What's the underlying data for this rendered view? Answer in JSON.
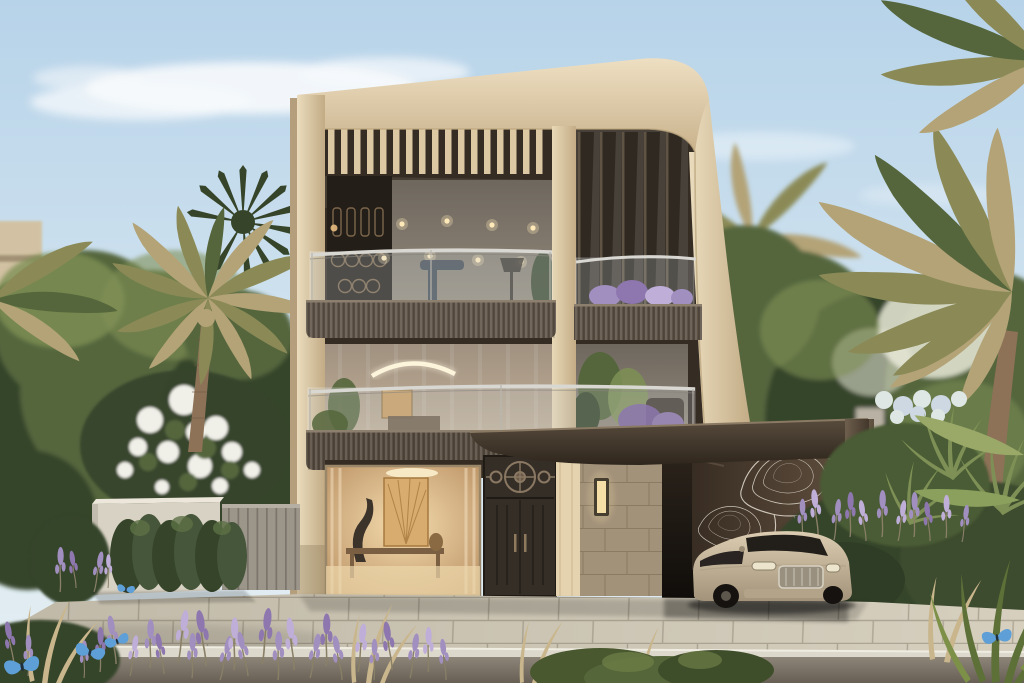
{
  "meta": {
    "title": "Luxury modern villa — daylight architectural rendering",
    "medium": "photorealistic exterior render"
  },
  "scene": {
    "setting": "Three-storey contemporary luxury villa framed by a sculptural cream travertine shell with a large rounded top corner",
    "sky": "clear pale blue sky with soft white clouds",
    "lighting": "bright daylight, sun from the upper left",
    "landscape": [
      "date palm trees",
      "dark fan palm",
      "dense green background trees",
      "white flowering shrub over garden wall",
      "clipped green hedge",
      "grey slatted garden fence",
      "lavender beds with dried grasses",
      "ferns and tropical foliage",
      "pale blue hydrangea shrub",
      "purple flower spikes"
    ],
    "foreground": "stone-paved driveway with light curb and planted verge",
    "background_left": "beige low-rise building behind trees"
  },
  "villa": {
    "unit_number": "01",
    "storeys": 3,
    "top_floor": [
      "timber pergola slats under curved roof frame",
      "dark bronze mashrabiya screen panel",
      "glass-walled gym with warm ceiling spotlights, treadmill, floor lamp and plant",
      "curved glass balustrade balcony with ribbed bronze fascia",
      "tapered vertical bronze fins over glazing",
      "small balcony with lavender planter"
    ],
    "middle_floor": [
      "full-height glazing with sheer curtains",
      "curved white pendant light",
      "wall artwork and console",
      "indoor plants and armchair",
      "continuous curved glass balcony"
    ],
    "ground_floor": [
      "living room picture window with gold fan artwork, chandelier, sculpture and console",
      "dark bronze entrance door with circular rosette transom",
      "travertine stone-block wall with glowing sconce",
      "cream timber jamb column"
    ],
    "carport": {
      "roof": "dark bronze cantilevered canopy with slatted soffit",
      "wall_art": "white topographic contour-line artwork on bronze wall",
      "pillar": "bronze pillar with unit number",
      "car": "champagne luxury coupe with chrome grille"
    }
  },
  "wildlife": {
    "butterflies": {
      "count": 5,
      "color_name": "blue"
    }
  },
  "palette": {
    "sky-top": "#b7d3e9",
    "sky-low": "#dceaf2",
    "cloud": "#f7fafc",
    "frame-light": "#ecddc0",
    "frame": "#d9c6a2",
    "frame-dark": "#bda57f",
    "bronze-dark": "#352c24",
    "bronze": "#4a3f33",
    "bronze-light": "#6b5c4a",
    "glass-cool": "#7e776d",
    "glass-warm": "#a89a88",
    "interior-glow": "#ecd0a2",
    "gold": "#c99e62",
    "stone": "#a3927a",
    "rail": "#d9d7d2",
    "leaf-dark": "#36452a",
    "leaf": "#55663c",
    "leaf-light": "#7e9055",
    "palm-olive": "#8b8a57",
    "palm-tan": "#b3a377",
    "trunk": "#8d7258",
    "flower-white": "#f0efe8",
    "lavender": "#a18fc0",
    "pave": "#c6bfae",
    "curb": "#dcd8cc",
    "street": "#837b6e",
    "car-body": "#c6b69c",
    "butterfly": "#5d9fd6",
    "sign-metal": "#ab8f68"
  }
}
